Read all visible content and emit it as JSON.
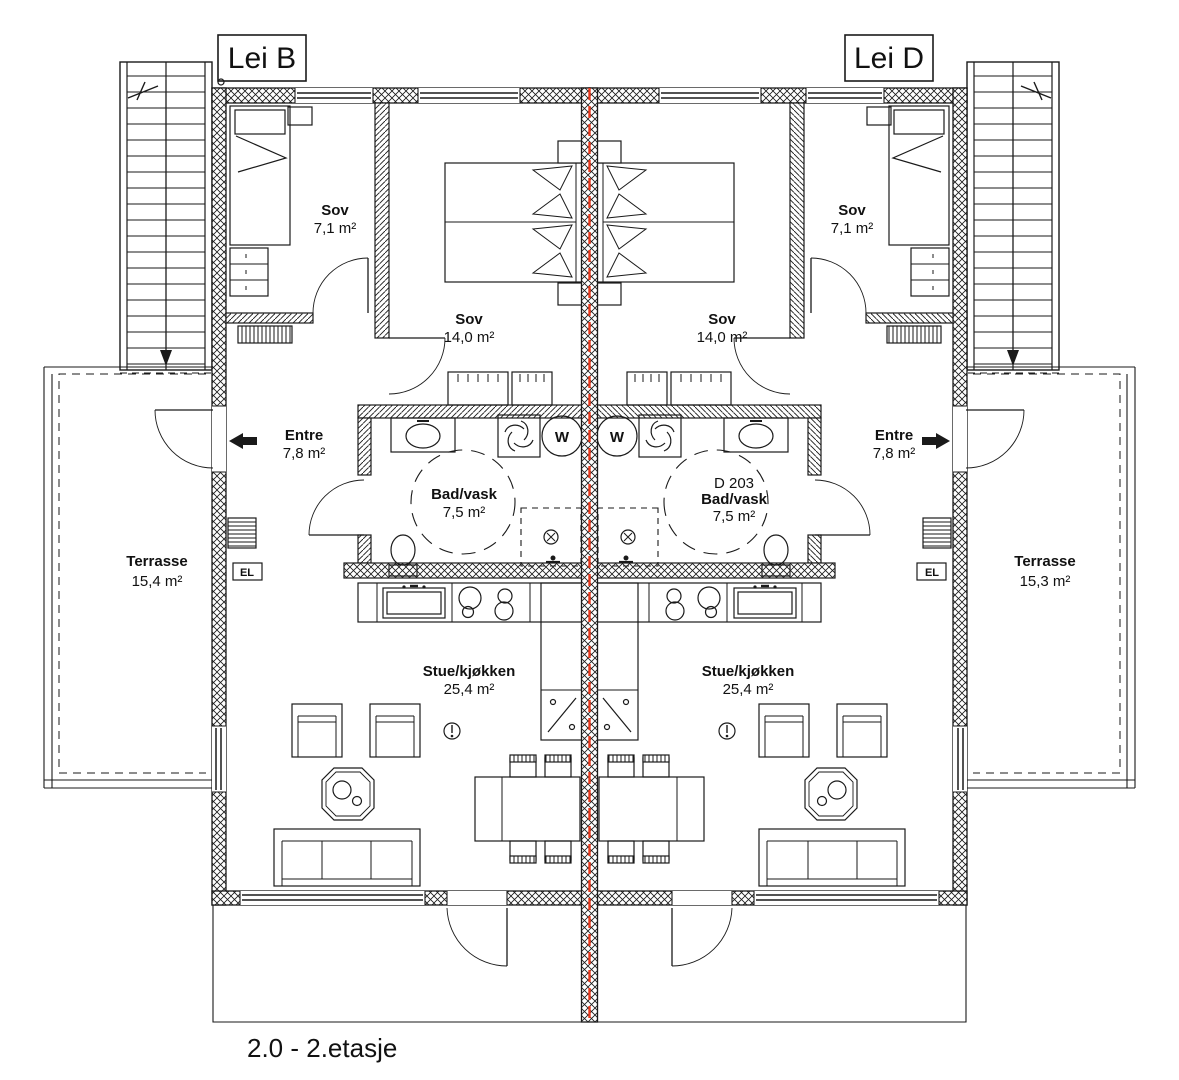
{
  "drawing_title": "2.0 - 2.etasje",
  "unit_labels": {
    "left": "Lei B",
    "right": "Lei D"
  },
  "rooms": {
    "sov_small_left": {
      "name": "Sov",
      "area": "7,1 m²"
    },
    "sov_small_right": {
      "name": "Sov",
      "area": "7,1 m²"
    },
    "sov_large_left": {
      "name": "Sov",
      "area": "14,0 m²"
    },
    "sov_large_right": {
      "name": "Sov",
      "area": "14,0 m²"
    },
    "entre_left": {
      "name": "Entre",
      "area": "7,8 m²"
    },
    "entre_right": {
      "name": "Entre",
      "area": "7,8 m²"
    },
    "bad_left": {
      "name": "Bad/vask",
      "area": "7,5 m²"
    },
    "bad_right": {
      "code": "D 203",
      "name": "Bad/vask",
      "area": "7,5 m²"
    },
    "stue_left": {
      "name": "Stue/kjøkken",
      "area": "25,4 m²"
    },
    "stue_right": {
      "name": "Stue/kjøkken",
      "area": "25,4 m²"
    },
    "terrasse_left": {
      "name": "Terrasse",
      "area": "15,4 m²"
    },
    "terrasse_right": {
      "name": "Terrasse",
      "area": "15,3 m²"
    }
  },
  "symbols": {
    "washer_label": "W",
    "el_label": "EL"
  },
  "colors": {
    "line": "#1a1a1a",
    "party_wall_centerline": "#e8391d",
    "background": "#ffffff"
  }
}
